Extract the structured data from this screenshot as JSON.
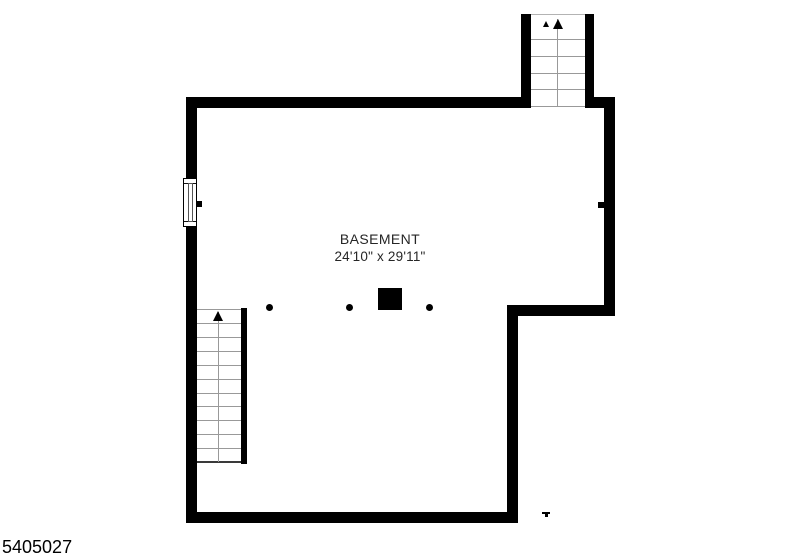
{
  "title": {
    "room_name": "BASEMENT",
    "room_dimensions": "24'10\" x 29'11\""
  },
  "footer": {
    "listing_id": "5405027"
  },
  "floorplan": {
    "upper_stairwell": {
      "direction": "up",
      "tread_count": 5
    },
    "lower_staircase": {
      "direction": "up",
      "tread_count": 10
    },
    "support_columns": {
      "round_count": 3,
      "square_count": 1
    },
    "colors": {
      "wall": "#000000",
      "tread_line": "#999999",
      "label_text": "#262626",
      "background": "#ffffff"
    }
  }
}
